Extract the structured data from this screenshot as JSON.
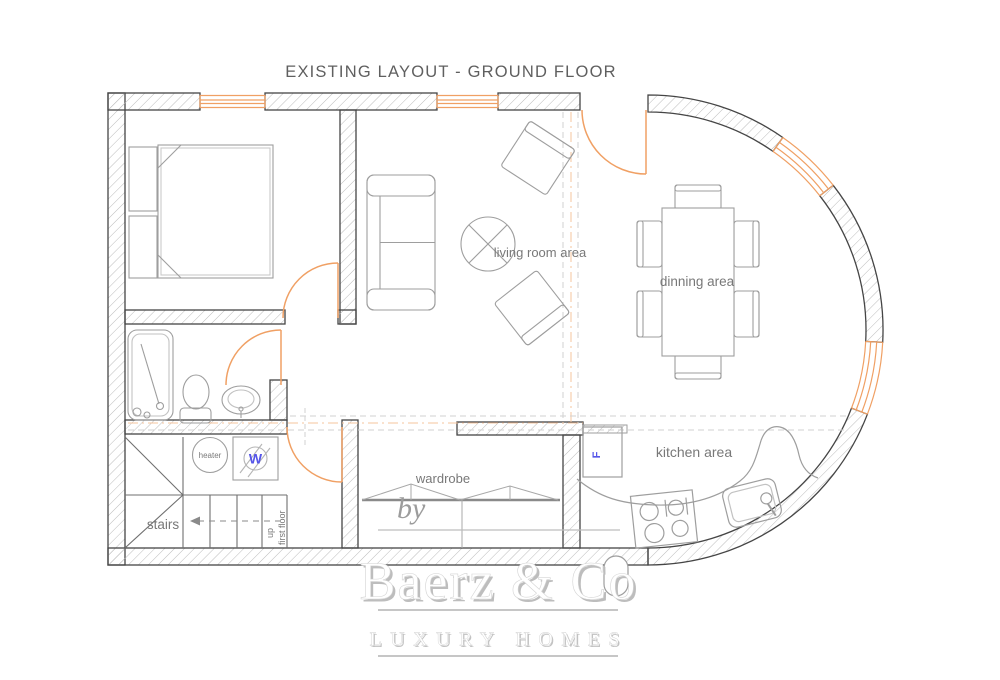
{
  "title": "EXISTING LAYOUT -  GROUND FLOOR",
  "rooms": {
    "living": {
      "label": "living room area"
    },
    "dining": {
      "label": "dinning area"
    },
    "kitchen": {
      "label": "kitchen area"
    },
    "wardrobe": {
      "label": "wardrobe"
    },
    "stairs": {
      "label": "stairs",
      "up_label": "up",
      "floor_label": "first floor"
    },
    "utility": {
      "heater_label": "heater",
      "washer_label": "W"
    },
    "appliances": {
      "fridge_label": "F"
    }
  },
  "watermark": {
    "by": "by",
    "brand": "Baerz & Co",
    "tagline": "LUXURY HOMES"
  },
  "colors": {
    "wall_outline": "#454545",
    "hatch": "#bcbcbc",
    "accent_orange": "#F0A064",
    "furniture_gray": "#9e9e9e",
    "label_gray": "#787878",
    "appliance_blue": "#5656E8"
  }
}
